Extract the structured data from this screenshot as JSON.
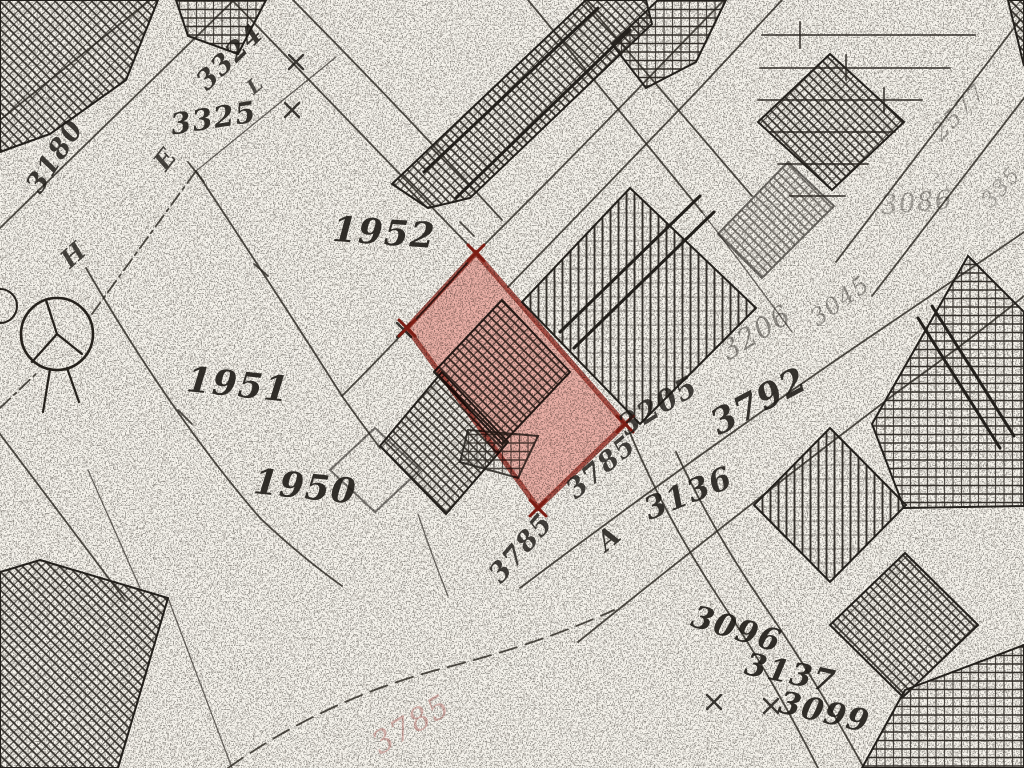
{
  "map": {
    "kind": "scanned-cadastral-plat",
    "background_color": "#f6f3ec",
    "ink_color": "#1e1b17",
    "highlight": {
      "fill_color": "#e0564a",
      "fill_opacity": 0.42,
      "stroke_color": "#993128",
      "stroke_width": 5,
      "corner_mark_color": "#7c1d14",
      "polygon": [
        [
          476,
          253
        ],
        [
          625,
          424
        ],
        [
          538,
          508
        ],
        [
          407,
          328
        ]
      ]
    },
    "survey_circle": {
      "x": 57,
      "y": 334,
      "r": 36
    },
    "cross_marks": [
      [
        714,
        702
      ],
      [
        771,
        706
      ],
      [
        296,
        62
      ],
      [
        292,
        110
      ],
      [
        404,
        330
      ]
    ],
    "labels": [
      {
        "text": "3324",
        "x": 231,
        "y": 58,
        "rot": -44,
        "size": 27,
        "op": 0.85
      },
      {
        "text": "L",
        "x": 256,
        "y": 86,
        "rot": -40,
        "size": 20,
        "op": 0.75
      },
      {
        "text": "3325",
        "x": 214,
        "y": 120,
        "rot": -9,
        "size": 29,
        "op": 0.88
      },
      {
        "text": "3180",
        "x": 56,
        "y": 157,
        "rot": -57,
        "size": 27,
        "op": 0.85
      },
      {
        "text": "E",
        "x": 167,
        "y": 160,
        "rot": -52,
        "size": 25,
        "op": 0.8
      },
      {
        "text": "H",
        "x": 75,
        "y": 256,
        "rot": -42,
        "size": 25,
        "op": 0.8
      },
      {
        "text": "1952",
        "x": 384,
        "y": 235,
        "rot": 4,
        "size": 35,
        "op": 0.9
      },
      {
        "text": "1951",
        "x": 238,
        "y": 387,
        "rot": 6,
        "size": 35,
        "op": 0.9
      },
      {
        "text": "1950",
        "x": 305,
        "y": 489,
        "rot": 6,
        "size": 35,
        "op": 0.9
      },
      {
        "text": "3785",
        "x": 522,
        "y": 549,
        "rot": -49,
        "size": 27,
        "op": 0.82
      },
      {
        "text": "3785",
        "x": 602,
        "y": 468,
        "rot": -40,
        "size": 27,
        "op": 0.82
      },
      {
        "text": "3205",
        "x": 659,
        "y": 407,
        "rot": -31,
        "size": 29,
        "op": 0.82
      },
      {
        "text": "A",
        "x": 610,
        "y": 539,
        "rot": -40,
        "size": 27,
        "op": 0.85
      },
      {
        "text": "3136",
        "x": 689,
        "y": 495,
        "rot": -22,
        "size": 31,
        "op": 0.88
      },
      {
        "text": "3792",
        "x": 760,
        "y": 403,
        "rot": -28,
        "size": 35,
        "op": 0.88
      },
      {
        "text": "3206",
        "x": 757,
        "y": 334,
        "rot": -32,
        "size": 28,
        "op": 0.45,
        "w": 400
      },
      {
        "text": "3045",
        "x": 841,
        "y": 302,
        "rot": -36,
        "size": 24,
        "op": 0.4,
        "w": 400
      },
      {
        "text": "2577",
        "x": 960,
        "y": 113,
        "rot": -46,
        "size": 24,
        "op": 0.35,
        "w": 400
      },
      {
        "text": "3086",
        "x": 917,
        "y": 204,
        "rot": -5,
        "size": 26,
        "op": 0.35,
        "w": 400
      },
      {
        "text": "335",
        "x": 1002,
        "y": 188,
        "rot": -48,
        "size": 22,
        "op": 0.32,
        "w": 400
      },
      {
        "text": "3096",
        "x": 736,
        "y": 631,
        "rot": 17,
        "size": 31,
        "op": 0.9
      },
      {
        "text": "3137",
        "x": 790,
        "y": 675,
        "rot": 12,
        "size": 31,
        "op": 0.9
      },
      {
        "text": "3099",
        "x": 824,
        "y": 714,
        "rot": 13,
        "size": 31,
        "op": 0.9
      },
      {
        "text": "3785",
        "x": 412,
        "y": 726,
        "rot": -31,
        "size": 31,
        "op": 0.4,
        "w": 400,
        "color": "#a85550"
      }
    ]
  }
}
